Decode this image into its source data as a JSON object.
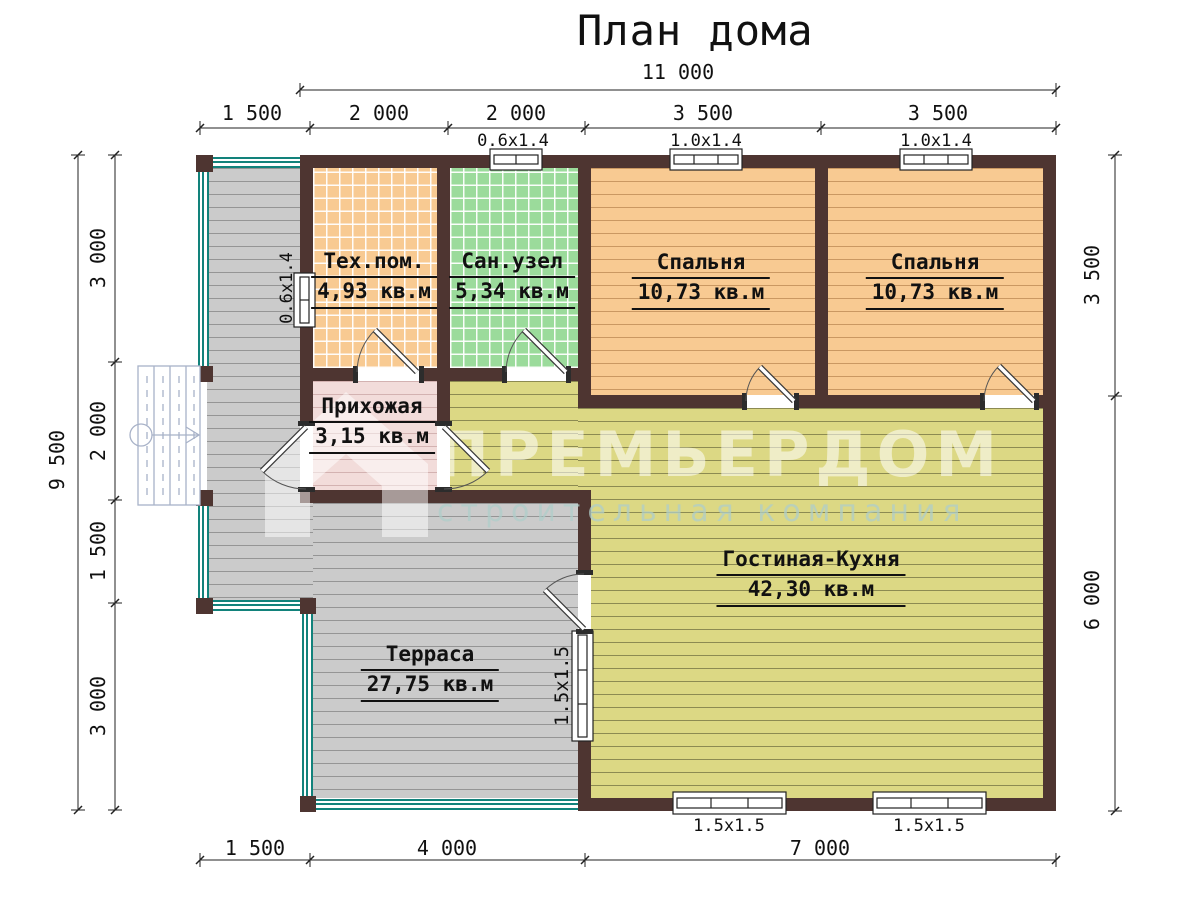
{
  "title": "План дома",
  "watermark": {
    "brand": "ПРЕМЬЕРДОМ",
    "tagline": "строительная компания"
  },
  "dims": {
    "top_total": "11 000",
    "top_segs": [
      "1 500",
      "2 000",
      "2 000",
      "3 500",
      "3 500"
    ],
    "top_windows": [
      "0.6x1.4",
      "1.0x1.4",
      "1.0x1.4"
    ],
    "left_total": "9 500",
    "left_segs": [
      "3 000",
      "2 000",
      "1 500",
      "3 000"
    ],
    "right_segs": [
      "3 500",
      "6 000"
    ],
    "bottom_segs": [
      "1 500",
      "4 000",
      "7 000"
    ],
    "bottom_windows": [
      "1.5x1.5",
      "1.5x1.5"
    ],
    "tech_window": "0.6x1.4",
    "living_window": "1.5x1.5"
  },
  "rooms": [
    {
      "id": "tech",
      "name": "Тех.пом.",
      "area": "4,93 кв.м"
    },
    {
      "id": "san",
      "name": "Сан.узел",
      "area": "5,34 кв.м"
    },
    {
      "id": "bedroom1",
      "name": "Спальня",
      "area": "10,73 кв.м"
    },
    {
      "id": "bedroom2",
      "name": "Спальня",
      "area": "10,73 кв.м"
    },
    {
      "id": "hall",
      "name": "Прихожая",
      "area": "3,15 кв.м"
    },
    {
      "id": "living",
      "name": "Гостиная-Кухня",
      "area": "42,30 кв.м"
    },
    {
      "id": "terrace",
      "name": "Терраса",
      "area": "27,75 кв.м"
    }
  ],
  "colors": {
    "wall": "#4e3531",
    "tech_floor": "#f8ca92",
    "san_floor": "#9bdb9b",
    "bedroom_floor": "#f8ca92",
    "hall_floor": "#f2dcda",
    "living_floor": "#dcd884",
    "terrace_floor": "#cbcbcb",
    "railing": "#12827b",
    "stairs": "#a8b2c8"
  }
}
